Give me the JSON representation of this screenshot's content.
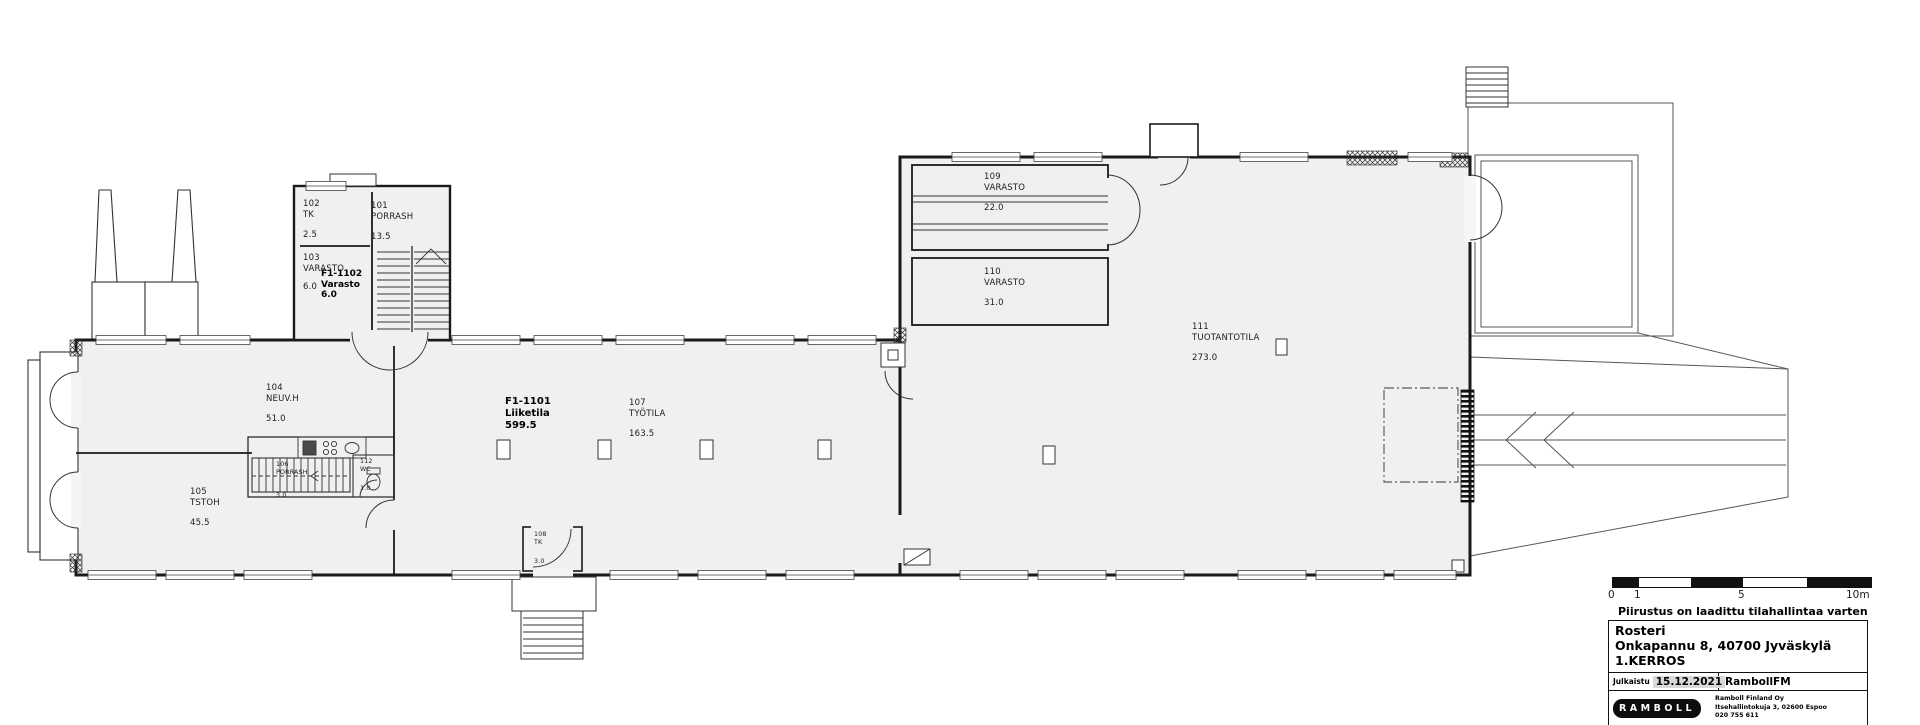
{
  "plan": {
    "rooms": [
      {
        "number": "101",
        "name": "PORRASH",
        "area": "13.5"
      },
      {
        "number": "102",
        "name": "TK",
        "area": "2.5"
      },
      {
        "number": "103",
        "name": "VARASTO",
        "area": "6.0"
      },
      {
        "number": "104",
        "name": "NEUV.H",
        "area": "51.0"
      },
      {
        "number": "105",
        "name": "TSTOH",
        "area": "45.5"
      },
      {
        "number": "106",
        "name": "PORRASH",
        "area": "3.0"
      },
      {
        "number": "107",
        "name": "TYÖTILA",
        "area": "163.5"
      },
      {
        "number": "108",
        "name": "TK",
        "area": "3.0"
      },
      {
        "number": "109",
        "name": "VARASTO",
        "area": "22.0"
      },
      {
        "number": "110",
        "name": "VARASTO",
        "area": "31.0"
      },
      {
        "number": "111",
        "name": "TUOTANTOTILA",
        "area": "273.0"
      },
      {
        "number": "112",
        "name": "WC",
        "area": "1.0"
      }
    ],
    "units": [
      {
        "code": "F1-1101",
        "name": "Liiketila",
        "area": "599.5"
      },
      {
        "code": "F1-1102",
        "name": "Varasto",
        "area": "6.0"
      }
    ]
  },
  "scalebar": {
    "labels": [
      "0",
      "1",
      "5",
      "10m"
    ]
  },
  "note": "Piirustus on laadittu tilahallintaa varten",
  "titleblock": {
    "title": "Rosteri",
    "address": "Onkapannu 8, 40700 Jyväskylä",
    "floor": "1.KERROS",
    "published_label": "Julkaistu",
    "published_date": "15.12.2021",
    "system": "RambollFM",
    "logo": "RAMBOLL",
    "company": "Ramboll Finland Oy",
    "company_address": "Itsehallintokuja 3,  02600 Espoo",
    "company_phone": "020 755 611"
  },
  "colors": {
    "floor_fill": "#f0f0ee",
    "line": "#2e2e2e"
  }
}
